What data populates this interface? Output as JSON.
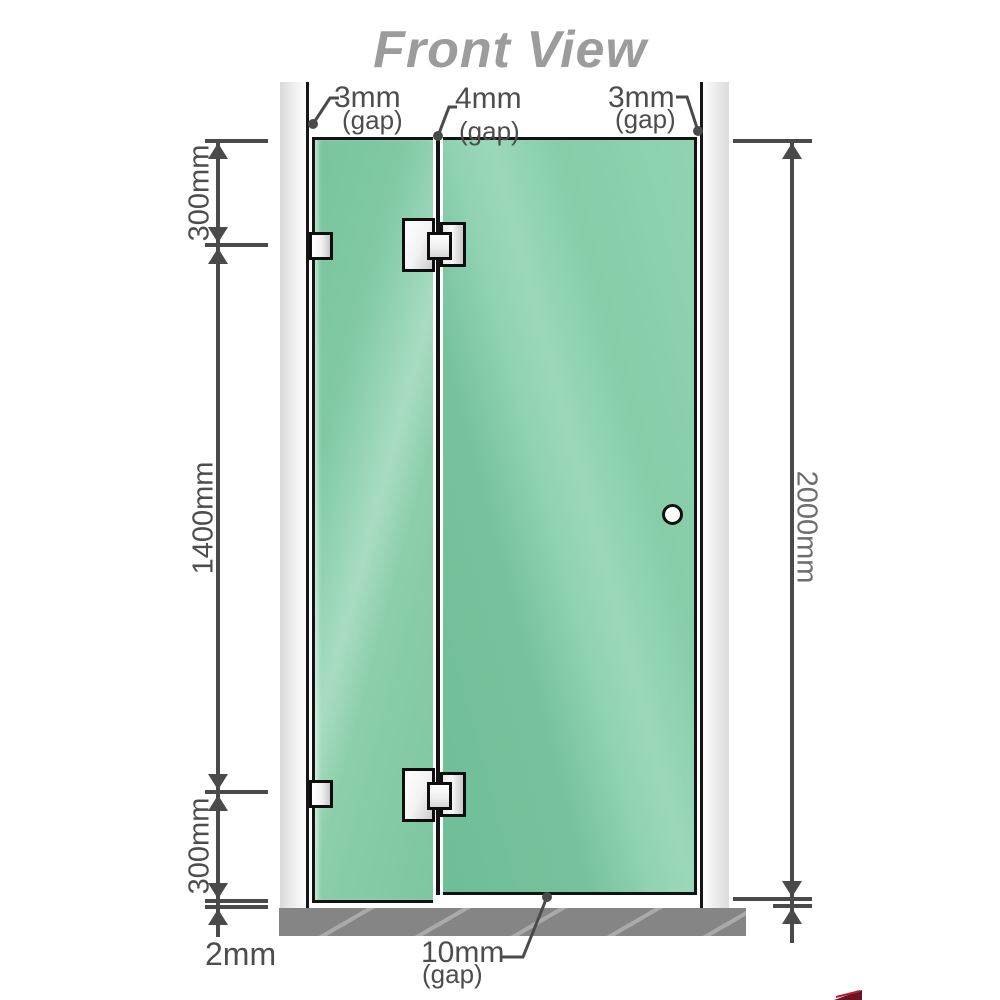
{
  "title": "Front View",
  "annotations": {
    "top_gaps": [
      {
        "value": "3mm",
        "label": "(gap)"
      },
      {
        "value": "4mm",
        "label": "(gap)"
      },
      {
        "value": "3mm",
        "label": "(gap)"
      }
    ],
    "bottom_gap": {
      "value": "10mm",
      "label": "(gap)"
    },
    "floor_clearance": "2mm"
  },
  "dimensions": {
    "left_top_segment": "300mm",
    "left_middle_segment": "1400mm",
    "left_bottom_segment": "300mm",
    "right_total_height": "2000mm"
  },
  "colors": {
    "title": "#9c9c9c",
    "glass_base": "#7ec8a2",
    "glass_highlight": "#9fd9bb",
    "glass_border": "#131313",
    "wall_channel": "#e2e2e2",
    "wall_edge": "#161616",
    "floor": "#858585",
    "hardware_fill": "#f0f0f0",
    "hardware_shade": "#c7c7c7",
    "dimension_line": "#4a4a4a",
    "label_text": "#4d4d4d",
    "total_label": "#6e6e6e",
    "brand_red": "#8c1830"
  }
}
